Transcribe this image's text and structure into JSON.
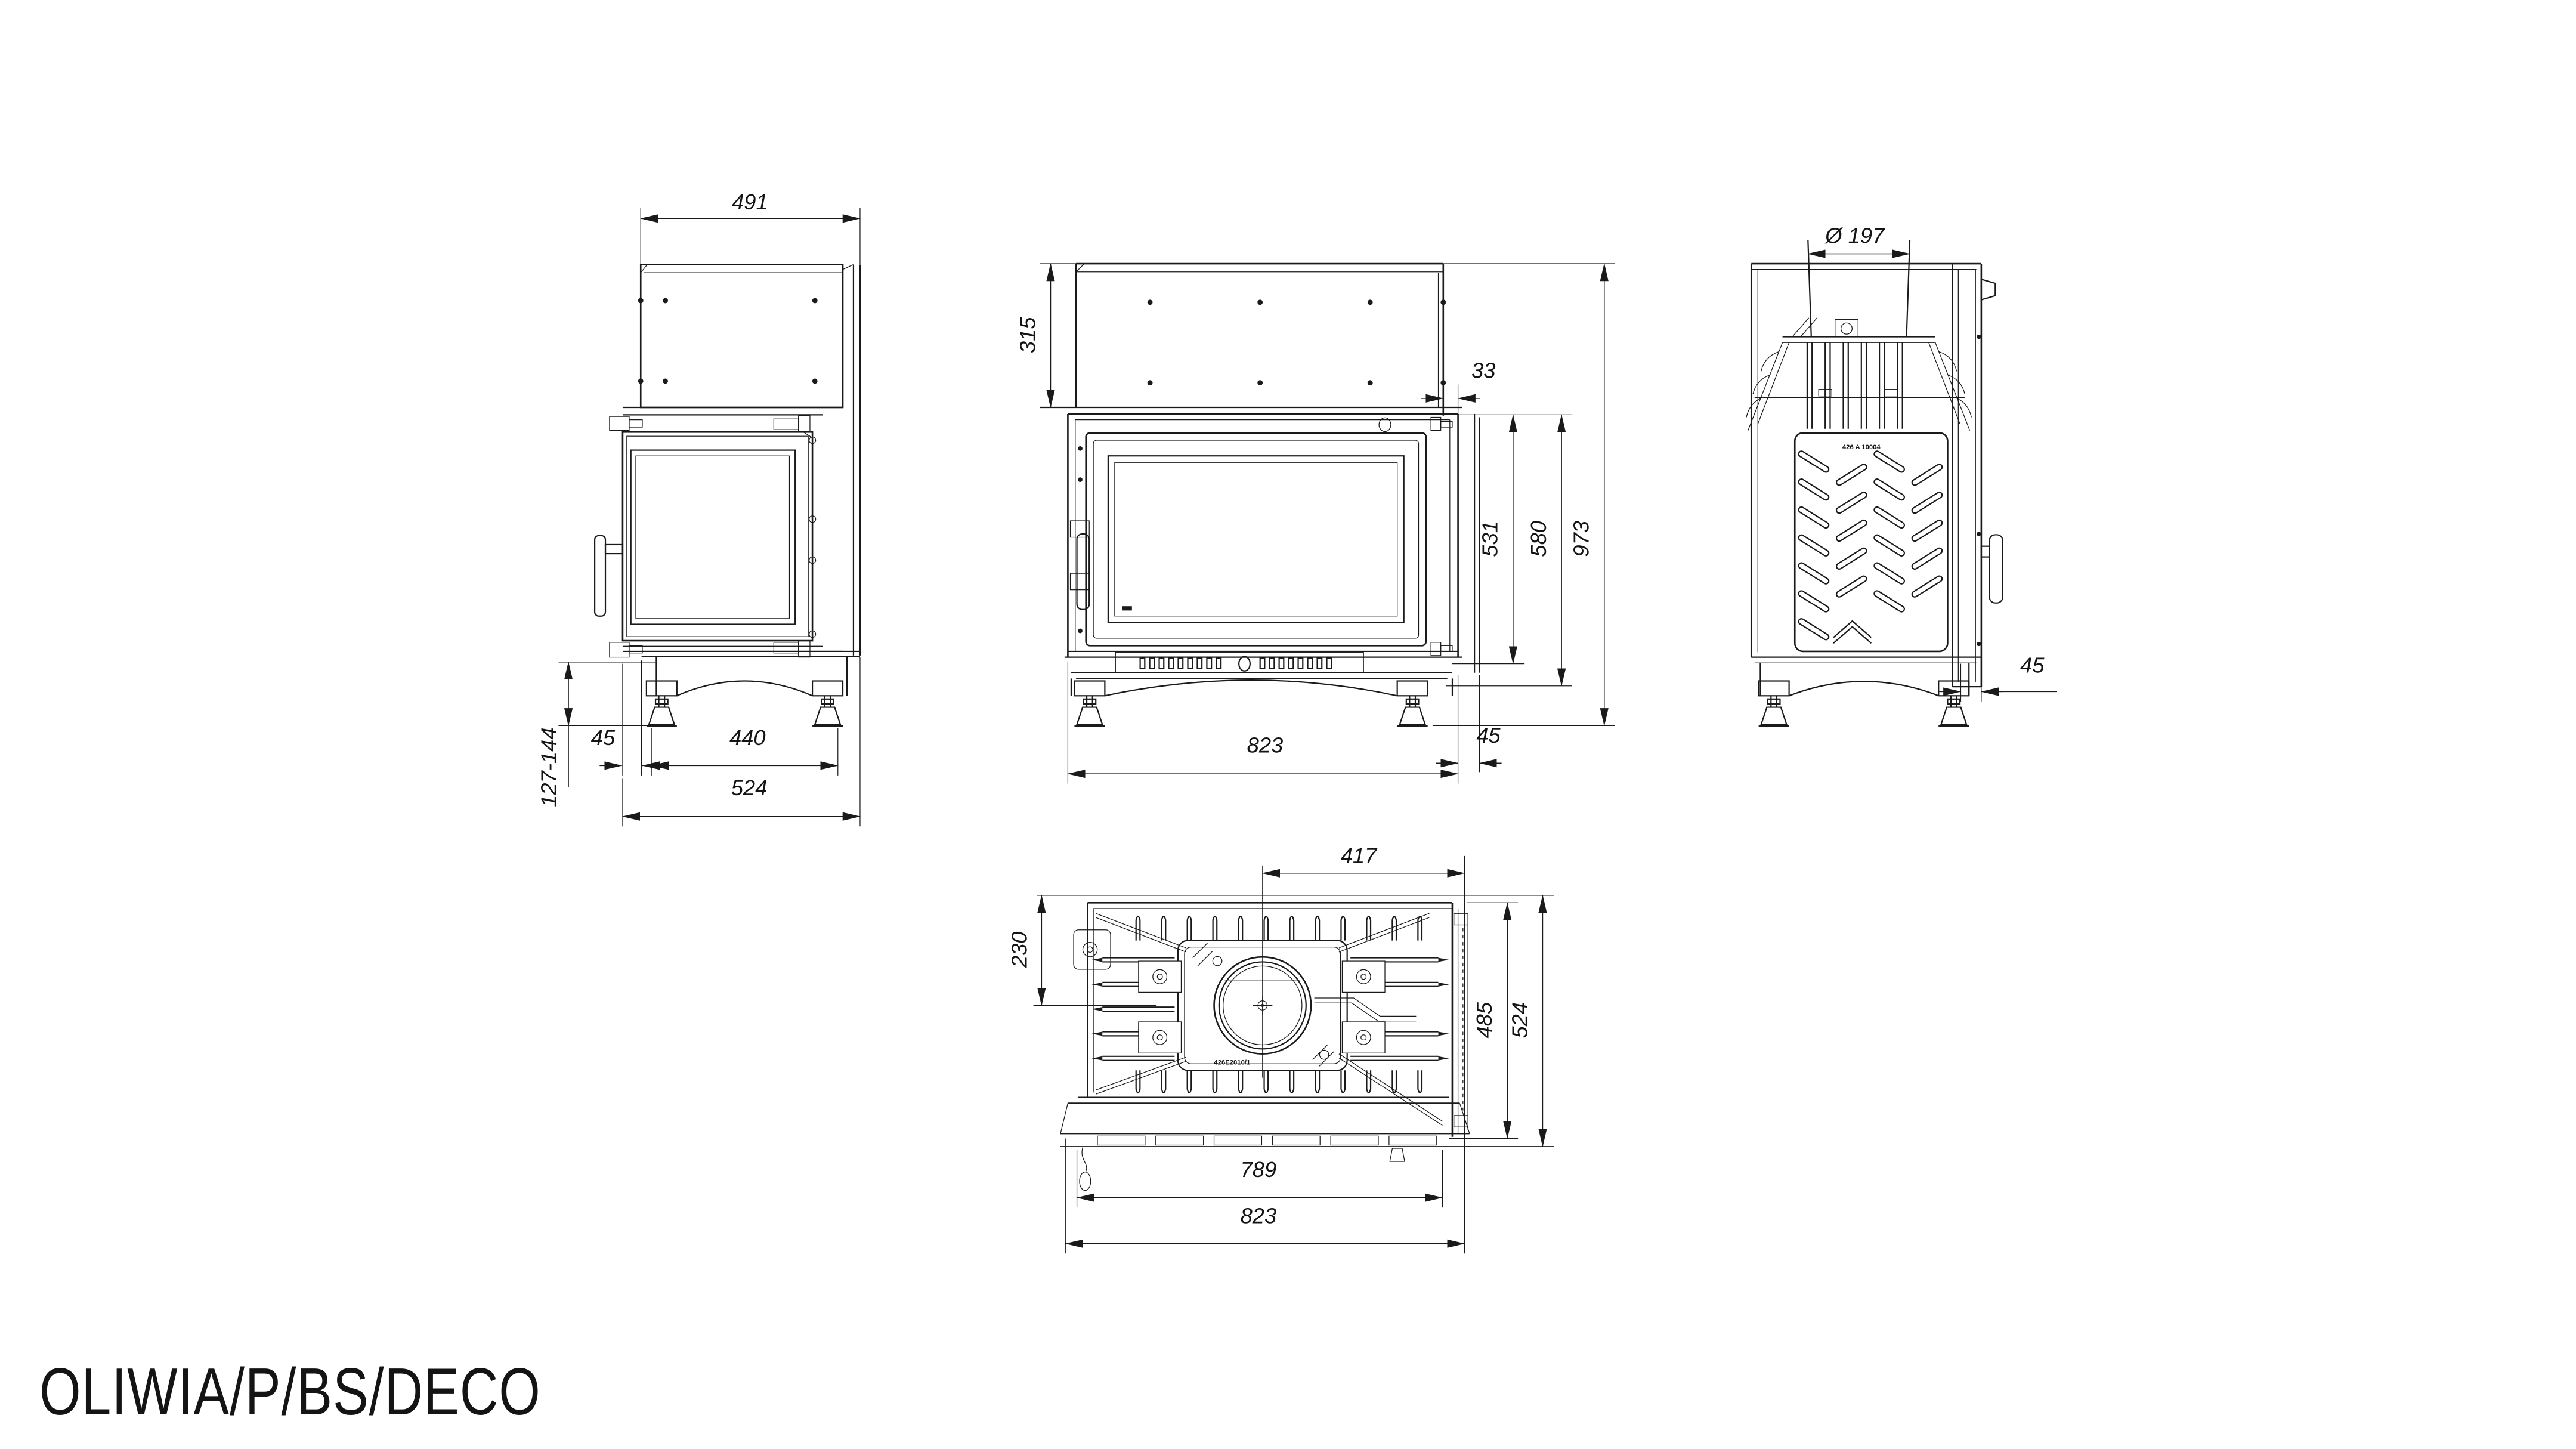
{
  "title": "OLIWIA/P/BS/DECO",
  "colors": {
    "line": "#1a1a1a",
    "background": "#ffffff"
  },
  "views": {
    "side_left": {
      "label": "left side view",
      "dims": {
        "top_depth": "491",
        "foot_height_range": "127-144",
        "front_overhang": "45",
        "feet_spacing": "440",
        "base_depth": "524"
      }
    },
    "front": {
      "label": "front view",
      "dims": {
        "upper_chamber_height": "315",
        "rear_offset": "33",
        "door_height": "531",
        "firebox_height": "580",
        "total_height": "973",
        "width": "823",
        "side_panel_offset": "45"
      }
    },
    "side_right": {
      "label": "right side view",
      "casting_number": "426 A 10004",
      "dims": {
        "flue_diameter": "Ø 197",
        "side_offset": "45"
      }
    },
    "plan": {
      "label": "top view",
      "casting_number": "426E2010/1",
      "dims": {
        "flue_center_from_right": "417",
        "flue_center_from_back": "230",
        "depth_to_front_edge": "485",
        "total_depth": "524",
        "front_width": "789",
        "total_width": "823"
      }
    }
  }
}
